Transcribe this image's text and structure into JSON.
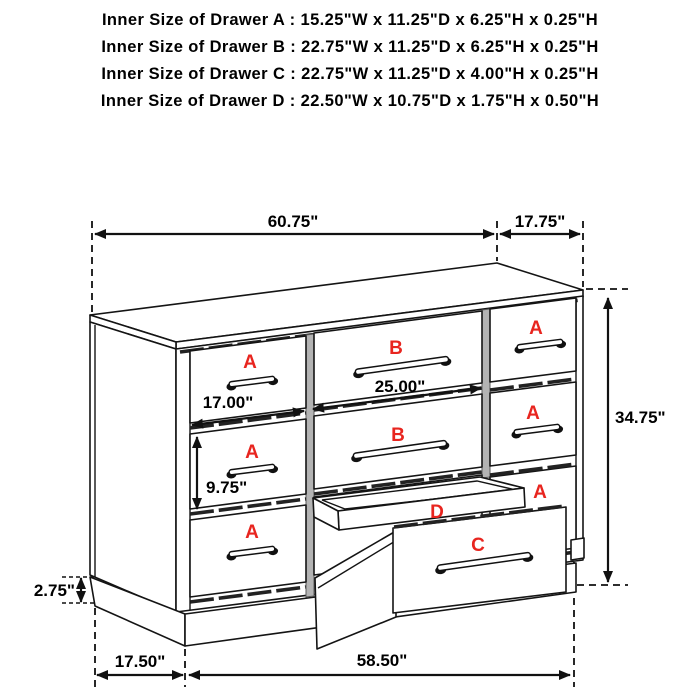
{
  "title_block": {
    "lines": [
      "Inner Size of Drawer A : 15.25\"W x 11.25\"D x 6.25\"H x 0.25\"H",
      "Inner Size of Drawer B : 22.75\"W x 11.25\"D x 6.25\"H x 0.25\"H",
      "Inner Size of Drawer C : 22.75\"W x 11.25\"D x 4.00\"H x 0.25\"H",
      "Inner Size of Drawer D : 22.50\"W x 10.75\"D x 1.75\"H x 0.50\"H"
    ]
  },
  "drawer_labels": {
    "a": "A",
    "b": "B",
    "c": "C",
    "d": "D"
  },
  "dimensions": {
    "top_width": "60.75\"",
    "top_depth": "17.75\"",
    "cabinet_height": "34.75\"",
    "drawer_b_width": "25.00\"",
    "drawer_a_width": "17.00\"",
    "drawer_a_face_height": "9.75\"",
    "base_height": "2.75\"",
    "base_depth": "17.50\"",
    "base_width": "58.50\""
  },
  "colors": {
    "background": "#ffffff",
    "line_black": "#141414",
    "label_red": "#e8251f",
    "divider_gray": "#b3b3b3"
  }
}
